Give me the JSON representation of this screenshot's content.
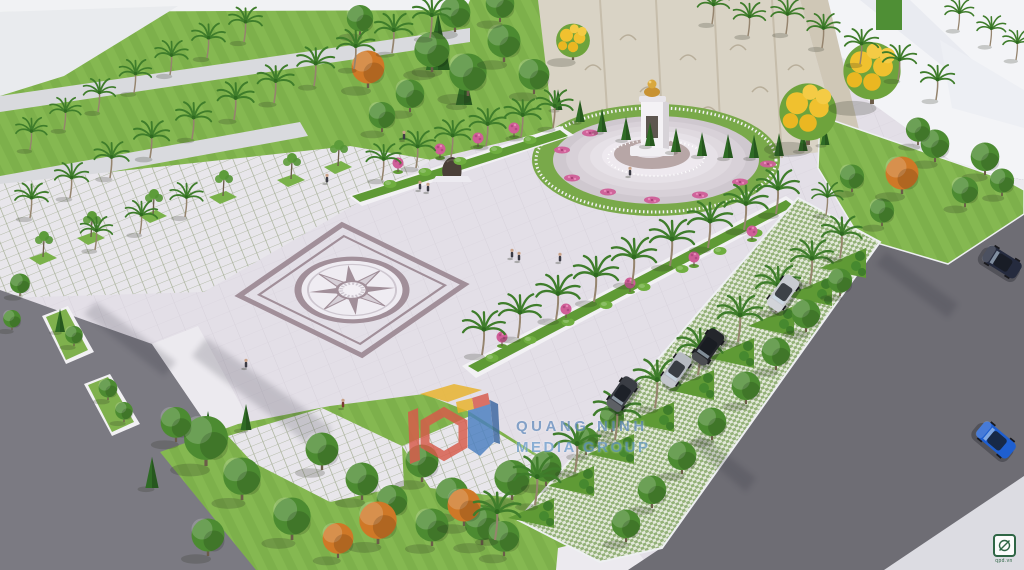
{
  "scene": {
    "description": "Aerial 3D architectural rendering of a memorial plaza with compass-rose paving, monument with golden bust, relief stone wall, palm-lined medians, angled parking and surrounding roads",
    "watermark": {
      "line1": "QUANG NINH",
      "line2": "MEDIA GROUP"
    },
    "corner_badge": {
      "text": "qpd.vn",
      "icon": "circle-slash-icon"
    },
    "colors": {
      "plaza": "#e3dfe7",
      "plazaLine": "#d7d2db",
      "lawn": "#85b851",
      "lawnStripe": "#7db04b",
      "lawnDark": "#5f9a35",
      "treeGreen": "#4c8b31",
      "treeOrange": "#cf7827",
      "palmGreen": "#3f7d2b",
      "trunk": "#95846e",
      "paleRoad": "#d9dade",
      "asphalt": "#6e6d74",
      "asphaltLight": "#7b7a82",
      "sidewalk": "#eceaef",
      "wall": "#d9d3c5",
      "wallSeam": "#c6bdab",
      "building": "#f3f4f7",
      "buildingShade": "#e4e6ed",
      "compass": "#a18f99",
      "compassLight": "#efecf2",
      "compassMid": "#cdc6cf",
      "stepTop": "#b7a6a6",
      "pink": "#cf5e97",
      "gold": "#d9a83e",
      "gridJoint": "#a3ad92",
      "paverGreen": "#93b177"
    }
  },
  "vegetation": {
    "palms": [
      [
        30,
        150,
        0.7
      ],
      [
        64,
        130,
        0.7
      ],
      [
        98,
        112,
        0.72
      ],
      [
        134,
        93,
        0.72
      ],
      [
        170,
        75,
        0.74
      ],
      [
        207,
        58,
        0.75
      ],
      [
        244,
        42,
        0.75
      ],
      [
        30,
        218,
        0.75
      ],
      [
        70,
        198,
        0.76
      ],
      [
        110,
        178,
        0.78
      ],
      [
        150,
        158,
        0.8
      ],
      [
        192,
        139,
        0.8
      ],
      [
        234,
        120,
        0.82
      ],
      [
        274,
        103,
        0.82
      ],
      [
        314,
        86,
        0.84
      ],
      [
        354,
        69,
        0.85
      ],
      [
        392,
        53,
        0.85
      ],
      [
        430,
        38,
        0.85
      ],
      [
        95,
        250,
        0.72
      ],
      [
        140,
        234,
        0.72
      ],
      [
        185,
        217,
        0.74
      ],
      [
        382,
        180,
        0.78
      ],
      [
        416,
        168,
        0.8
      ],
      [
        451,
        157,
        0.8
      ],
      [
        486,
        146,
        0.82
      ],
      [
        521,
        137,
        0.82
      ],
      [
        553,
        128,
        0.82
      ],
      [
        482,
        355,
        0.95
      ],
      [
        518,
        338,
        0.95
      ],
      [
        556,
        320,
        0.98
      ],
      [
        594,
        302,
        1
      ],
      [
        632,
        284,
        1
      ],
      [
        670,
        266,
        1
      ],
      [
        708,
        248,
        1
      ],
      [
        744,
        230,
        0.98
      ],
      [
        776,
        214,
        0.95
      ],
      [
        535,
        505,
        1.05
      ],
      [
        575,
        472,
        1.05
      ],
      [
        615,
        440,
        1.05
      ],
      [
        655,
        408,
        1.05
      ],
      [
        698,
        375,
        1.02
      ],
      [
        738,
        342,
        1
      ],
      [
        776,
        312,
        1
      ],
      [
        810,
        284,
        0.95
      ],
      [
        840,
        258,
        0.9
      ],
      [
        495,
        540,
        1.05
      ],
      [
        712,
        24,
        0.72
      ],
      [
        748,
        36,
        0.72
      ],
      [
        786,
        34,
        0.74
      ],
      [
        822,
        48,
        0.74
      ],
      [
        860,
        64,
        0.76
      ],
      [
        898,
        80,
        0.76
      ],
      [
        936,
        100,
        0.76
      ],
      [
        958,
        30,
        0.65
      ],
      [
        990,
        46,
        0.65
      ],
      [
        1016,
        60,
        0.65
      ],
      [
        826,
        215,
        0.7
      ]
    ],
    "green_trees": [
      [
        432,
        72,
        1.6
      ],
      [
        468,
        96,
        1.7
      ],
      [
        504,
        62,
        1.5
      ],
      [
        534,
        94,
        1.4
      ],
      [
        455,
        32,
        1.4
      ],
      [
        500,
        22,
        1.3
      ],
      [
        410,
        112,
        1.3
      ],
      [
        382,
        132,
        1.2
      ],
      [
        360,
        35,
        1.2
      ],
      [
        985,
        175,
        1.3
      ],
      [
        1002,
        196,
        1.1
      ],
      [
        965,
        207,
        1.2
      ],
      [
        882,
        226,
        1.1
      ],
      [
        852,
        192,
        1.1
      ],
      [
        935,
        162,
        1.3
      ],
      [
        918,
        145,
        1.1
      ],
      [
        806,
        332,
        1.3
      ],
      [
        776,
        370,
        1.3
      ],
      [
        746,
        404,
        1.3
      ],
      [
        712,
        440,
        1.3
      ],
      [
        682,
        474,
        1.3
      ],
      [
        652,
        508,
        1.3
      ],
      [
        626,
        542,
        1.3
      ],
      [
        840,
        296,
        1.1
      ],
      [
        206,
        466,
        2.0
      ],
      [
        242,
        500,
        1.7
      ],
      [
        176,
        442,
        1.4
      ],
      [
        322,
        470,
        1.5
      ],
      [
        362,
        500,
        1.5
      ],
      [
        292,
        540,
        1.7
      ],
      [
        422,
        482,
        1.5
      ],
      [
        452,
        515,
        1.5
      ],
      [
        392,
        520,
        1.4
      ],
      [
        482,
        545,
        1.6
      ],
      [
        208,
        556,
        1.5
      ],
      [
        512,
        500,
        1.6
      ],
      [
        546,
        486,
        1.4
      ],
      [
        432,
        546,
        1.5
      ],
      [
        504,
        556,
        1.4
      ],
      [
        612,
        432,
        1.1
      ],
      [
        586,
        455,
        1.1
      ],
      [
        74,
        346,
        0.8
      ],
      [
        108,
        400,
        0.85
      ],
      [
        124,
        422,
        0.8
      ],
      [
        20,
        296,
        0.9
      ],
      [
        12,
        330,
        0.8
      ]
    ],
    "orange_trees": [
      [
        368,
        88,
        1.5
      ],
      [
        902,
        194,
        1.5
      ],
      [
        378,
        544,
        1.7
      ],
      [
        464,
        526,
        1.5
      ],
      [
        338,
        558,
        1.4
      ]
    ],
    "yellow_trees": [
      [
        573,
        60,
        1.3
      ],
      [
        808,
        145,
        2.2
      ],
      [
        872,
        104,
        2.2
      ]
    ],
    "conifers": [
      [
        558,
        110,
        0.8
      ],
      [
        580,
        122,
        0.85
      ],
      [
        602,
        132,
        0.9
      ],
      [
        626,
        140,
        0.9
      ],
      [
        650,
        146,
        0.92
      ],
      [
        676,
        152,
        0.92
      ],
      [
        702,
        156,
        0.92
      ],
      [
        728,
        158,
        0.92
      ],
      [
        754,
        158,
        0.9
      ],
      [
        779,
        156,
        0.88
      ],
      [
        803,
        151,
        0.85
      ],
      [
        825,
        145,
        0.8
      ],
      [
        438,
        70,
        2.2
      ],
      [
        464,
        105,
        1.5
      ],
      [
        208,
        450,
        1.5
      ],
      [
        152,
        488,
        1.2
      ],
      [
        246,
        430,
        1.0
      ],
      [
        60,
        332,
        0.9
      ]
    ],
    "pit_trees": [
      [
        40,
        258
      ],
      [
        88,
        238
      ],
      [
        150,
        216
      ],
      [
        220,
        197
      ],
      [
        288,
        180
      ],
      [
        335,
        167
      ]
    ],
    "pink_topiaries": [
      [
        398,
        172
      ],
      [
        440,
        158
      ],
      [
        478,
        147
      ],
      [
        514,
        137
      ],
      [
        502,
        346
      ],
      [
        566,
        318
      ],
      [
        630,
        292
      ],
      [
        694,
        266
      ],
      [
        752,
        240
      ]
    ],
    "flower_patches": [
      [
        572,
        178
      ],
      [
        608,
        192
      ],
      [
        652,
        200
      ],
      [
        700,
        195
      ],
      [
        740,
        182
      ],
      [
        768,
        164
      ],
      [
        562,
        150
      ],
      [
        590,
        133
      ]
    ],
    "hedge_bushes": [
      [
        390,
        184
      ],
      [
        425,
        172
      ],
      [
        460,
        161
      ],
      [
        496,
        150
      ],
      [
        530,
        140
      ],
      [
        492,
        358
      ],
      [
        530,
        340
      ],
      [
        568,
        322
      ],
      [
        606,
        305
      ],
      [
        644,
        287
      ],
      [
        682,
        269
      ],
      [
        720,
        251
      ],
      [
        756,
        233
      ]
    ],
    "park_islands": [
      [
        508,
        518
      ],
      [
        548,
        486
      ],
      [
        588,
        454
      ],
      [
        628,
        422
      ],
      [
        668,
        390
      ],
      [
        708,
        358
      ],
      [
        748,
        326
      ],
      [
        786,
        296
      ],
      [
        820,
        268
      ]
    ]
  },
  "vehicles": {
    "cars": [
      {
        "x": 783,
        "y": 293,
        "angle": -55,
        "scale": 1.1,
        "color": "#c8cbd1",
        "kind": "silver-suv"
      },
      {
        "x": 708,
        "y": 347,
        "angle": -55,
        "scale": 1.1,
        "color": "#24262b",
        "kind": "black-suv"
      },
      {
        "x": 676,
        "y": 370,
        "angle": -55,
        "scale": 1.05,
        "color": "#b6bac1",
        "kind": "silver-sedan"
      },
      {
        "x": 622,
        "y": 394,
        "angle": -55,
        "scale": 1.05,
        "color": "#3a3d44",
        "kind": "gray-car"
      },
      {
        "x": 1002,
        "y": 262,
        "angle": 32,
        "scale": 1.15,
        "color": "#252b3e",
        "kind": "navy-car"
      },
      {
        "x": 996,
        "y": 440,
        "angle": 40,
        "scale": 1.2,
        "color": "#1f5fd0",
        "kind": "blue-car"
      }
    ]
  },
  "people": [
    [
      343,
      408,
      "#7a3a32"
    ],
    [
      246,
      368
    ],
    [
      420,
      190
    ],
    [
      428,
      192
    ],
    [
      404,
      140
    ],
    [
      512,
      258
    ],
    [
      519,
      261
    ],
    [
      327,
      183
    ],
    [
      630,
      176
    ],
    [
      560,
      262
    ]
  ]
}
